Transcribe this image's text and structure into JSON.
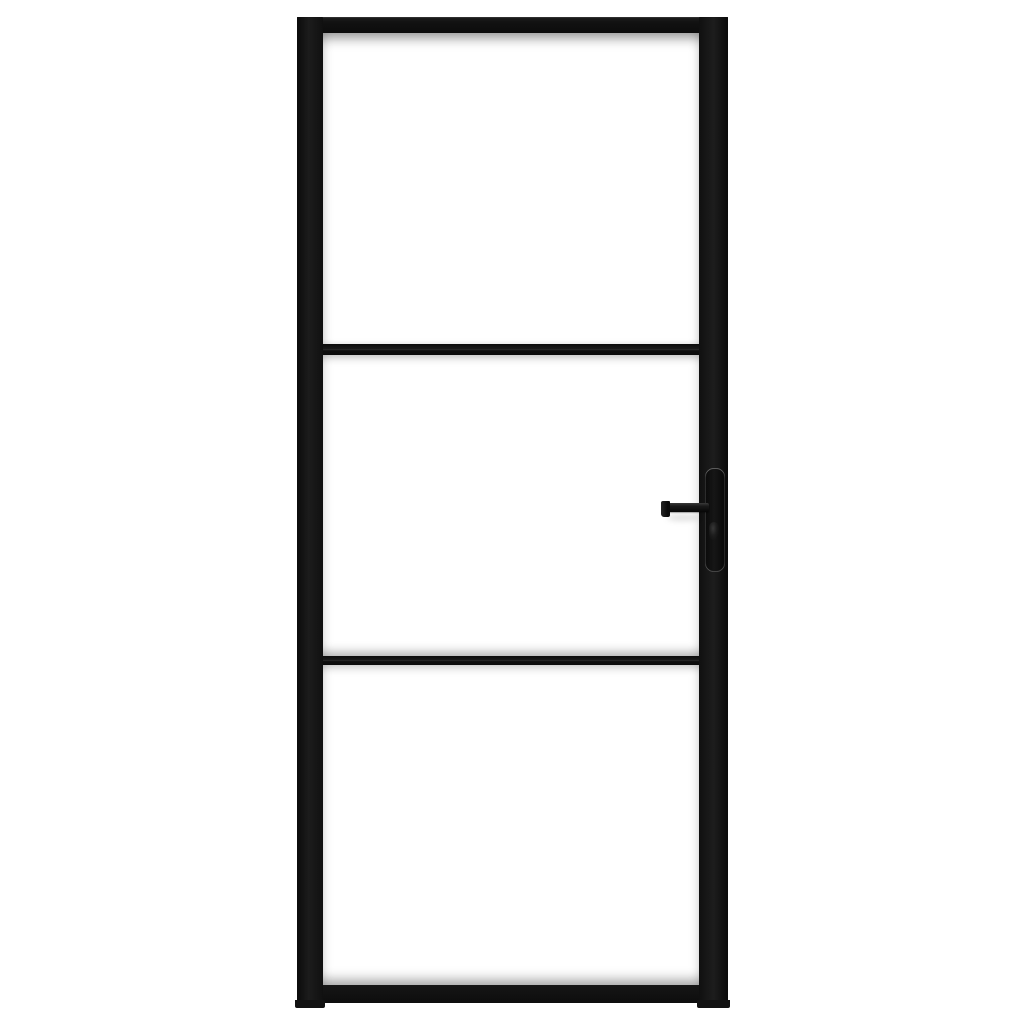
{
  "scene": {
    "type": "product-photo",
    "subject": "Interior glass door with black metal frame, three glass panels and a black lever handle, photographed front-on against a plain white background",
    "background_color": "#ffffff"
  },
  "door": {
    "frame_color": "#121212",
    "frame_highlight_color": "#3a3a3a",
    "glass_color": "#ffffff",
    "panel_count": 3,
    "panels": [
      "top",
      "middle",
      "bottom"
    ],
    "mullion_count": 2,
    "handle": {
      "type": "lever-on-long-backplate",
      "color": "#0d0d0d",
      "mounted_on": "right-stile",
      "lever_direction": "left"
    }
  }
}
